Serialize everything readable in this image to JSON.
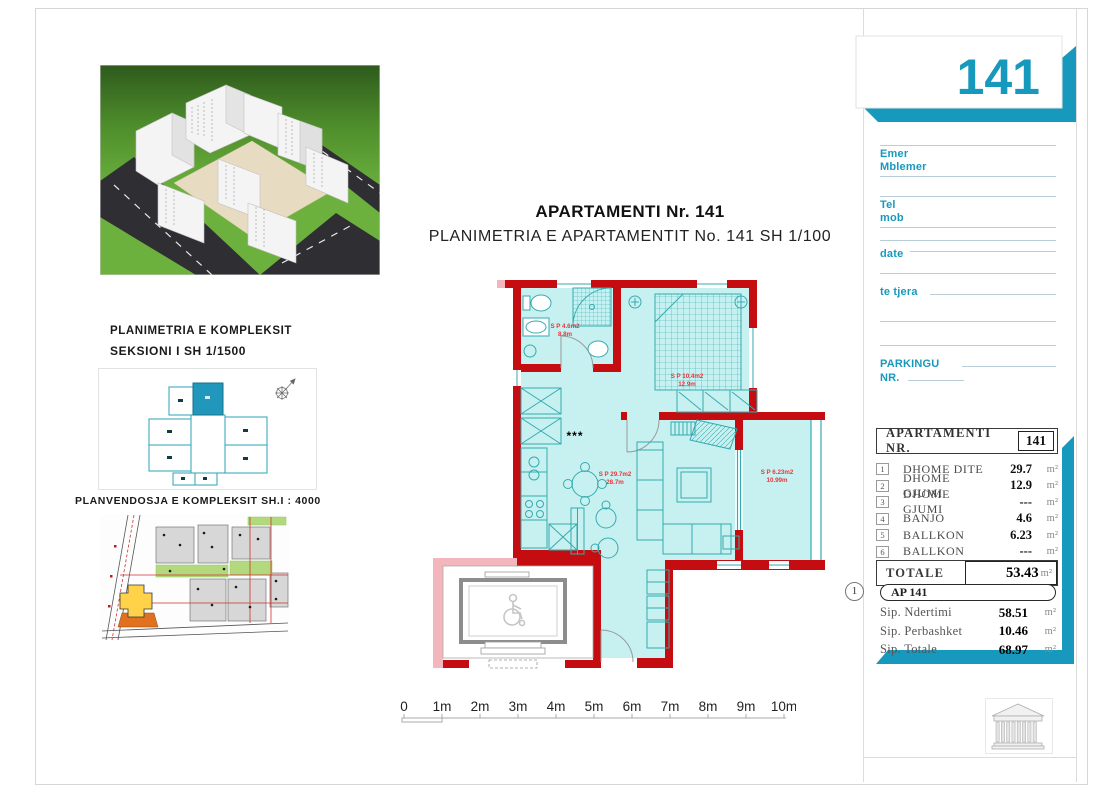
{
  "accent": "#1799bd",
  "sheet_number": "141",
  "header": {
    "title": "APARTAMENTI Nr. 141",
    "subtitle": "PLANIMETRIA E APARTAMENTIT No. 141 SH 1/100"
  },
  "left_panel": {
    "complex_plan_caption_line1": "PLANIMETRIA E KOMPLEKSIT",
    "complex_plan_caption_line2": "SEKSIONI I   SH 1/1500",
    "site_plan_caption": "PLANVENDOSJA E KOMPLEKSIT SH.I : 4000"
  },
  "contact_form": {
    "fields": [
      {
        "label": "Emer"
      },
      {
        "label": "Mblemer"
      },
      {
        "label": "Tel"
      },
      {
        "label": "mob"
      },
      {
        "label": "date"
      },
      {
        "label": "te tjera"
      },
      {
        "label": "PARKINGU"
      },
      {
        "label": "NR."
      }
    ]
  },
  "area_table": {
    "header_label": "APARTAMENTI  NR.",
    "header_number": "141",
    "rows": [
      {
        "num": "1",
        "name": "DHOME DITE",
        "value": "29.7",
        "unit": "m²"
      },
      {
        "num": "2",
        "name": "DHOME GJUMI",
        "value": "12.9",
        "unit": "m²"
      },
      {
        "num": "3",
        "name": "DHOME GJUMI",
        "value": "---",
        "unit": "m²"
      },
      {
        "num": "4",
        "name": "BANJO",
        "value": "4.6",
        "unit": "m²"
      },
      {
        "num": "5",
        "name": "BALLKON",
        "value": "6.23",
        "unit": "m²"
      },
      {
        "num": "6",
        "name": "BALLKON",
        "value": "---",
        "unit": "m²"
      }
    ],
    "total_label": "TOTALE",
    "total_value": "53.43",
    "total_unit": "m²"
  },
  "summary": {
    "marker": "1",
    "title": "AP 141",
    "rows": [
      {
        "name": "Sip. Ndertimi",
        "value": "58.51",
        "unit": "m²"
      },
      {
        "name": "Sip. Perbashket",
        "value": "10.46",
        "unit": "m²"
      },
      {
        "name": "Sip. Totale",
        "value": "68.97",
        "unit": "m²"
      }
    ]
  },
  "floor_plan": {
    "rooms": [
      {
        "id": "banjo",
        "area": "S P 4.6m2",
        "perimeter": "8.8m"
      },
      {
        "id": "dhome-gjumi",
        "area": "S P 10.4m2",
        "perimeter": "12.9m"
      },
      {
        "id": "dhome-dite",
        "area": "S P 29.7m2",
        "perimeter": "28.7m"
      },
      {
        "id": "ballkon",
        "area": "S P 6.23m2",
        "perimeter": "10.99m"
      }
    ],
    "shaft_label": "***"
  },
  "scale_bar": {
    "ticks": [
      "0",
      "1m",
      "2m",
      "3m",
      "4m",
      "5m",
      "6m",
      "7m",
      "8m",
      "9m",
      "10m"
    ]
  }
}
